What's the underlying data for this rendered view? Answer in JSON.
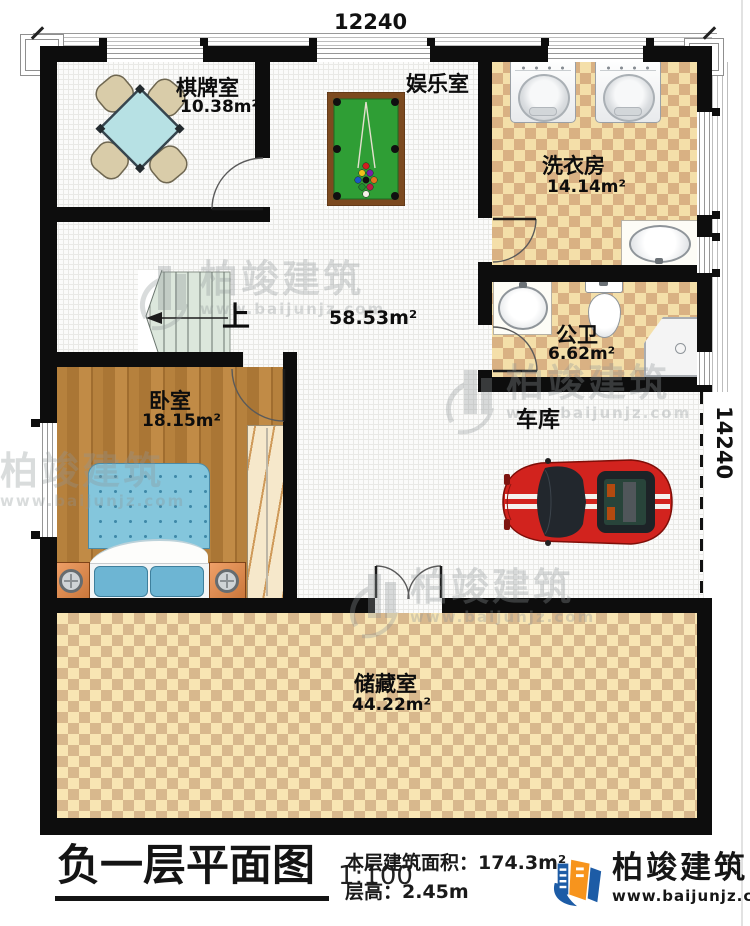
{
  "plan": {
    "dim_top": "12240",
    "dim_right": "14240",
    "up_label": "上",
    "hall_area": "58.53m²",
    "rooms": {
      "chess": {
        "name": "棋牌室",
        "area": "10.38m²"
      },
      "entertainment": {
        "name": "娱乐室"
      },
      "laundry": {
        "name": "洗衣房",
        "area": "14.14m²"
      },
      "bathroom": {
        "name": "公卫",
        "area": "6.62m²"
      },
      "bedroom": {
        "name": "卧室",
        "area": "18.15m²"
      },
      "garage": {
        "name": "车库"
      },
      "storage": {
        "name": "储藏室",
        "area": "44.22m²"
      }
    }
  },
  "footer": {
    "title": "负一层平面图",
    "scale": "1:100",
    "stats_line1": "本层建筑面积：174.3m²",
    "stats_line2": "层高：2.45m",
    "brand_name": "柏竣建筑",
    "brand_url": "www.baijunjz.com"
  },
  "watermark": {
    "name": "柏竣建筑",
    "url": "www.baijunjz.com"
  },
  "colors": {
    "wall": "#0d0d0d",
    "brand_blue": "#1d5ca6",
    "brand_orange": "#f7941d",
    "car_red": "#d2231e",
    "pool_green": "#2f9e35",
    "checker_tan": "#d9b183"
  }
}
